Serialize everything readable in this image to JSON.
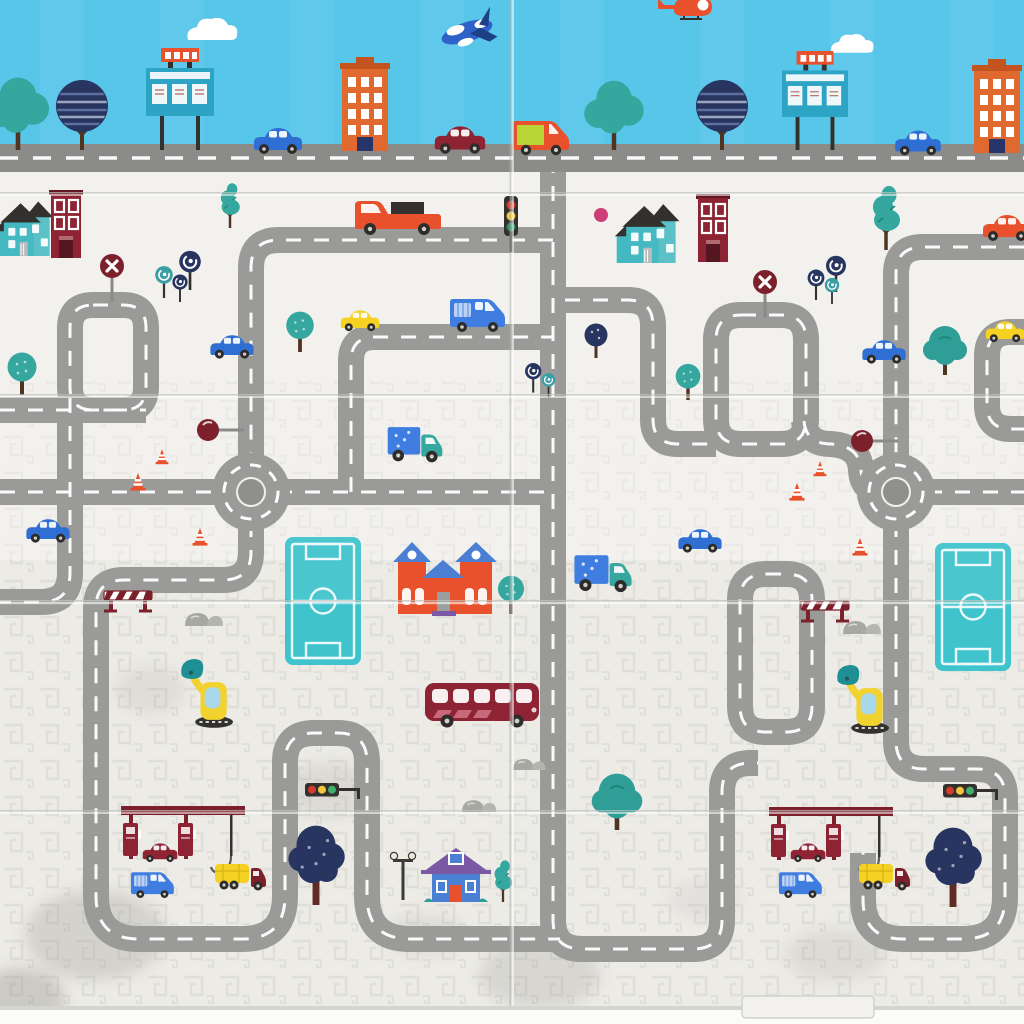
{
  "meta": {
    "title": "Foldable baby play mat - cartoon town road map print (photo)",
    "scene": "toy city traffic play mat with folding creases, two panels wide, greek-key texture on lower half"
  },
  "palette": {
    "sky": "#58c6e9",
    "mat": "#f2f1ed",
    "mat_low": "#ecebe6",
    "pattern": "#d6d6d0",
    "crease": "#c2c2bc",
    "road": "#9a9b98",
    "road_top": "#8b8c89",
    "dash": "#ffffff",
    "rb_center": "#8f908d",
    "field": "#3fc3cc",
    "navy": "#283560",
    "teal": "#35a79e",
    "teal_bush": "#2e9e96",
    "teal_house": "#45b9c2",
    "blue": "#2f6fd4",
    "blue_van": "#3f7de0",
    "blue_house": "#4a7fd4",
    "window_blue": "#a9d8ea",
    "lime": "#b8d435",
    "yellow": "#f4d122",
    "orange": "#df692e",
    "orange_red": "#e8512b",
    "maroon": "#8e2433",
    "maroon_dark": "#7c202c",
    "purple": "#7a58a4",
    "pink": "#cf3d77",
    "brown": "#4f3422",
    "trunk_maroon": "#5e2c22",
    "rock": "#a8a8a2",
    "charcoal": "#33312e",
    "wheel": "#2e2c2a",
    "excv_yellow": "#f2d22e",
    "scoop": "#1f8f96",
    "red_light": "#d23b2f",
    "yellow_light": "#f3c63d",
    "green_light": "#3fae6e",
    "bus_stripe": "#c9687a",
    "edge": "#d5d5cf"
  },
  "inventory": {
    "sky_strip": [
      "blue-jet",
      "orange-helicopter",
      "clouds",
      "teal-blob-tree x2",
      "navy-striped-round-tree x2",
      "teal-billboard x2",
      "orange-apartment-tower x2",
      "blue-sedan x2",
      "dark-red-sedan",
      "orange-delivery-van",
      "gray-highway-with-dashes"
    ],
    "vehicles_on_mat": [
      "red-pickup-truck",
      "blue-sedan x5",
      "yellow-taxi x2",
      "blue-van",
      "cargo-truck-teal-cab x2",
      "dark-red-bus",
      "yellow-excavator x2",
      "yellow-tanker-truck x2",
      "small-dark-red-sedan x2",
      "small-blue-van x2",
      "orange-sedan-at-edge"
    ],
    "buildings_on_mat": [
      "teal-gable-house x2",
      "maroon-rowhouse x2",
      "orange-house-blue-roofs",
      "blue-cottage-purple-roof",
      "gas-station-canopy x2",
      "teal-soccer-field x2"
    ],
    "trees": [
      "pine-teal x3",
      "round-teal-tree x4",
      "lollipop-spiral-trees x3 clusters",
      "navy-dot-tree",
      "bushy-teal-tree x2",
      "big-navy-tree x2"
    ],
    "signs_and_props": [
      "crossing-x-sign x2",
      "ball-sign x2",
      "vertical-traffic-light",
      "horizontal-traffic-light x2",
      "road-barrier x2",
      "traffic-cone x6",
      "street-lamp",
      "pink-dot",
      "gray-rocks x4"
    ],
    "road_features": [
      "roundabout x2",
      "looped-road-circuits",
      "fold-creases",
      "bottom-edge-tab"
    ]
  }
}
